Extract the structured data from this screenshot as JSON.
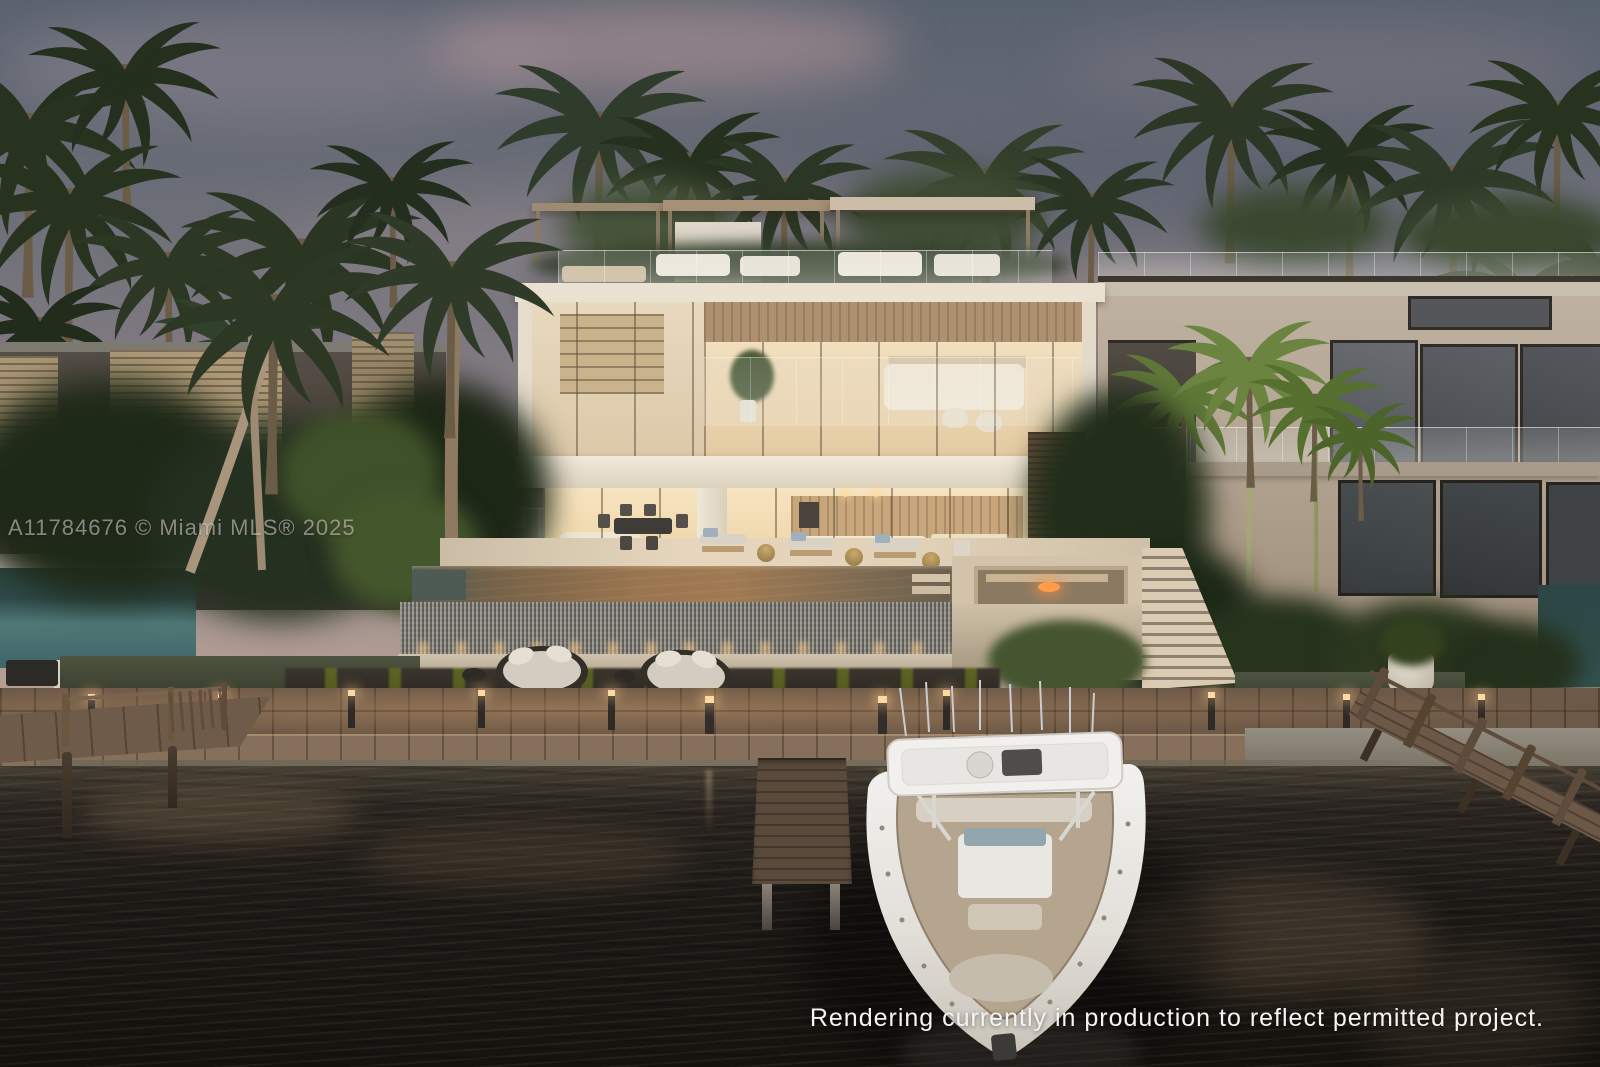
{
  "watermark": {
    "text": "A11784676 © Miami MLS® 2025"
  },
  "caption": {
    "text": "Rendering currently in production to reflect permitted project."
  },
  "palette": {
    "sky-top": "#59626f",
    "sky-mid": "#8d8289",
    "sky-horizon": "#c9a795",
    "cloud-pink": "#bb9595",
    "cloud-slate": "#5c6575",
    "foliage-dark": "#1f2918",
    "foliage-mid": "#2e3a26",
    "foliage-bright": "#5d7340",
    "house-cream": "#eae1d0",
    "interior-glow": "#f6e2ba",
    "wood-accent": "#ae9171",
    "stone-brown": "#5e4a39",
    "left-house": "#4a4239",
    "left-louver": "#b8a37e",
    "right-house": "#b3a593",
    "window-dark": "#4a4e50",
    "pool-amber": "#9a7550",
    "pool-teal": "#4f7876",
    "tile-wall": "#7a776e",
    "deck-wood": "#86705b",
    "sand": "#7b7262",
    "water-dark": "#16130f",
    "boat-white": "#f1f0ed",
    "light-warm": "#ffd9a2"
  }
}
